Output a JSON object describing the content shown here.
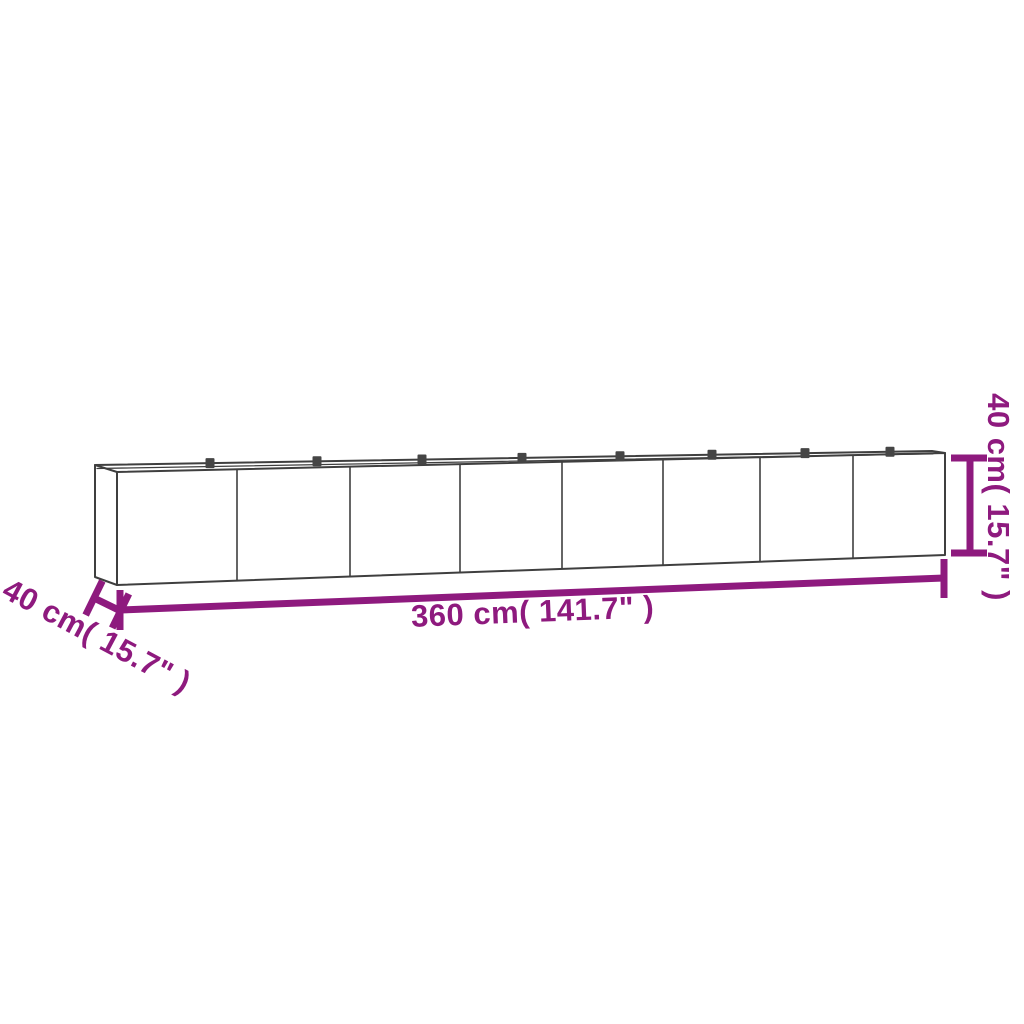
{
  "diagram": {
    "type": "product-dimension-drawing",
    "subject": "long rectangular garden planter box, open top, 8 front panels, viewed from front-left",
    "panel_count": 8,
    "rim_clip_count": 8,
    "labels": {
      "length": "360 cm( 141.7\" )",
      "depth": "40 cm( 15.7\" )",
      "height": "40 cm( 15.7\" )"
    }
  },
  "colors": {
    "dimension": "#8e1a7e",
    "outline": "#3f3f3f",
    "clip": "#454545",
    "background": "#ffffff"
  }
}
